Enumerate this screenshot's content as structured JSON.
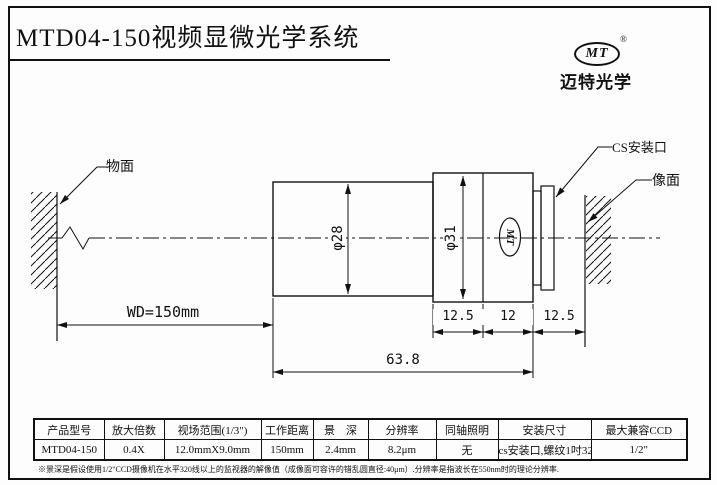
{
  "page": {
    "title": "MTD04-150视频显微光学系统"
  },
  "logo": {
    "mark": "MT",
    "registered": "®",
    "company": "迈特光学"
  },
  "diagram": {
    "labels": {
      "object_plane": "物面",
      "cs_mount": "CS安装口",
      "image_plane": "像面"
    },
    "dims": {
      "wd": "WD=150mm",
      "d28": "φ28",
      "d31": "φ31",
      "seg1": "12.5",
      "seg2": "12",
      "seg3": "12.5",
      "total": "63.8"
    },
    "lens_mark": "MT"
  },
  "table": {
    "headers": [
      "产品型号",
      "放大倍数",
      "视场范围(1/3\")",
      "工作距离",
      "景　深",
      "分辨率",
      "同轴照明",
      "安装尺寸",
      "最大兼容CCD"
    ],
    "row": [
      "MTD04-150",
      "0.4X",
      "12.0mmX9.0mm",
      "150mm",
      "2.4mm",
      "8.2μm",
      "无",
      "cs安装口,螺纹1吋32牙",
      "1/2\""
    ]
  },
  "footnote": "※景深是假设使用1/2\"CCD摄像机在水平320线以上的监视器的解像值（成像面可容许的错乱圆直径:40μm）.分辨率是指波长在550nm时的理论分辨率."
}
